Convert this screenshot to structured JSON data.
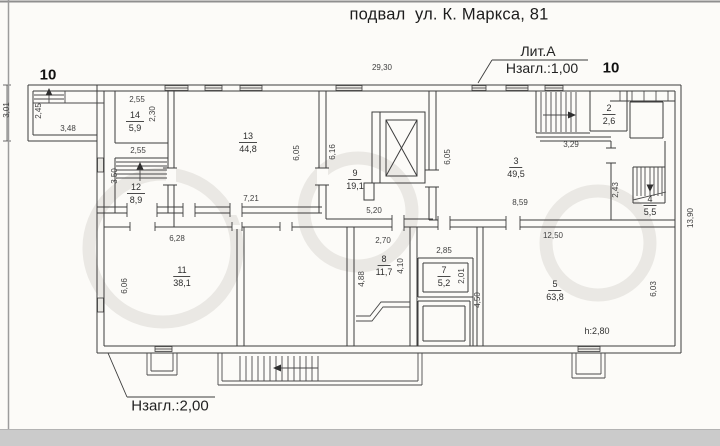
{
  "title": "подвал  ул. К. Маркса, 81",
  "annotations": {
    "lit_a": "Лит.А",
    "nzagl_top": "Нзагл.:1,00",
    "nzagl_bottom": "Нзагл.:2,00",
    "marker_top_left": "10",
    "marker_top_right": "10",
    "height_note": "h:2,80"
  },
  "rooms": [
    {
      "number": "14",
      "area": "5,9"
    },
    {
      "number": "12",
      "area": "8,9"
    },
    {
      "number": "13",
      "area": "44,8"
    },
    {
      "number": "9",
      "area": "19,1"
    },
    {
      "number": "3",
      "area": "49,5"
    },
    {
      "number": "2",
      "area": "2,6"
    },
    {
      "number": "4",
      "area": "5,5"
    },
    {
      "number": "11",
      "area": "38,1"
    },
    {
      "number": "8",
      "area": "11,7"
    },
    {
      "number": "7",
      "area": "5,2"
    },
    {
      "number": "5",
      "area": "63,8"
    }
  ],
  "dimensions": {
    "d2930": "29,30",
    "d301": "3,01",
    "d245": "2,45",
    "d348": "3,48",
    "d255a": "2,55",
    "d230": "2,30",
    "d255b": "2,55",
    "d350": "3,50",
    "d605a": "6,05",
    "d721": "7,21",
    "d616": "6,16",
    "d520": "5,20",
    "d605b": "6,05",
    "d329": "3,29",
    "d859": "8,59",
    "d243": "2,43",
    "d1390": "13,90",
    "d628": "6,28",
    "d606": "6,06",
    "d270": "2,70",
    "d488": "4,88",
    "d410": "4,10",
    "d285": "2,85",
    "d201": "2,01",
    "d450": "4,50",
    "d1250": "12,50",
    "d603": "6,03"
  }
}
